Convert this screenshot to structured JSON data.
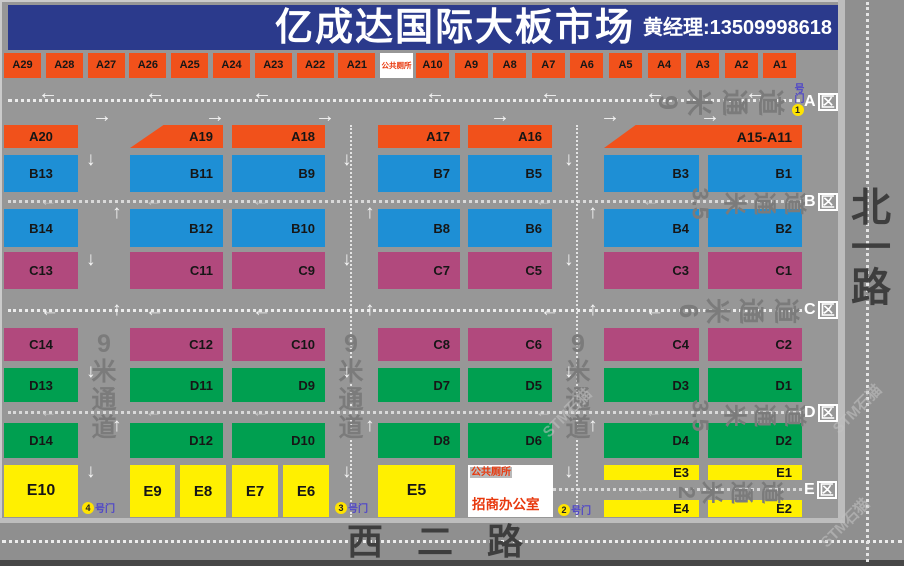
{
  "header": {
    "title": "亿成达国际大板市场",
    "contact": "黄经理:13509998618"
  },
  "roads": {
    "right_road": "北一路",
    "bottom_road": "西二路"
  },
  "channels": {
    "top": "9米通道",
    "row_b": "3.5米通道",
    "row_c": "6米通道",
    "row_d": "3.5米通道",
    "row_e": "2米通道",
    "vertical": "9米通道"
  },
  "zone_tags": [
    "A",
    "B",
    "C",
    "D",
    "E"
  ],
  "zone_suffix": "区",
  "gates": {
    "suffix": "号门",
    "gate1": "1",
    "gate2": "2",
    "gate3": "3",
    "gate4": "4"
  },
  "facilities": {
    "toilet": "公共厕所",
    "office": "招商办公室"
  },
  "watermark": "STM石猫",
  "stalls": {
    "a_top_left": [
      "A29",
      "A28",
      "A27",
      "A26",
      "A25",
      "A24",
      "A23",
      "A22",
      "A21"
    ],
    "a_top_right": [
      "A10",
      "A9",
      "A8",
      "A7",
      "A6",
      "A5",
      "A4",
      "A3",
      "A2",
      "A1"
    ],
    "a_main": [
      "A20",
      "A19",
      "A18",
      "A17",
      "A16",
      "A15-A11"
    ],
    "b_upper": [
      "B13",
      "B11",
      "B9",
      "B7",
      "B5",
      "B3",
      "B1"
    ],
    "b_lower": [
      "B14",
      "B12",
      "B10",
      "B8",
      "B6",
      "B4",
      "B2"
    ],
    "c_upper": [
      "C13",
      "C11",
      "C9",
      "C7",
      "C5",
      "C3",
      "C1"
    ],
    "c_lower": [
      "C14",
      "C12",
      "C10",
      "C8",
      "C6",
      "C4",
      "C2"
    ],
    "d_upper": [
      "D13",
      "D11",
      "D9",
      "D7",
      "D5",
      "D3",
      "D1"
    ],
    "d_lower": [
      "D14",
      "D12",
      "D10",
      "D8",
      "D6",
      "D4",
      "D2"
    ],
    "e_row": [
      "E10",
      "E9",
      "E8",
      "E7",
      "E6",
      "E5",
      "E3",
      "E4",
      "E1",
      "E2"
    ]
  },
  "colors": {
    "zone_a": "#f1511b",
    "zone_b": "#1e8fd5",
    "zone_c": "#b1497d",
    "zone_d": "#009f50",
    "zone_e": "#fff000",
    "header_bg": "#2b3a8c",
    "red_text": "#e8380d"
  }
}
